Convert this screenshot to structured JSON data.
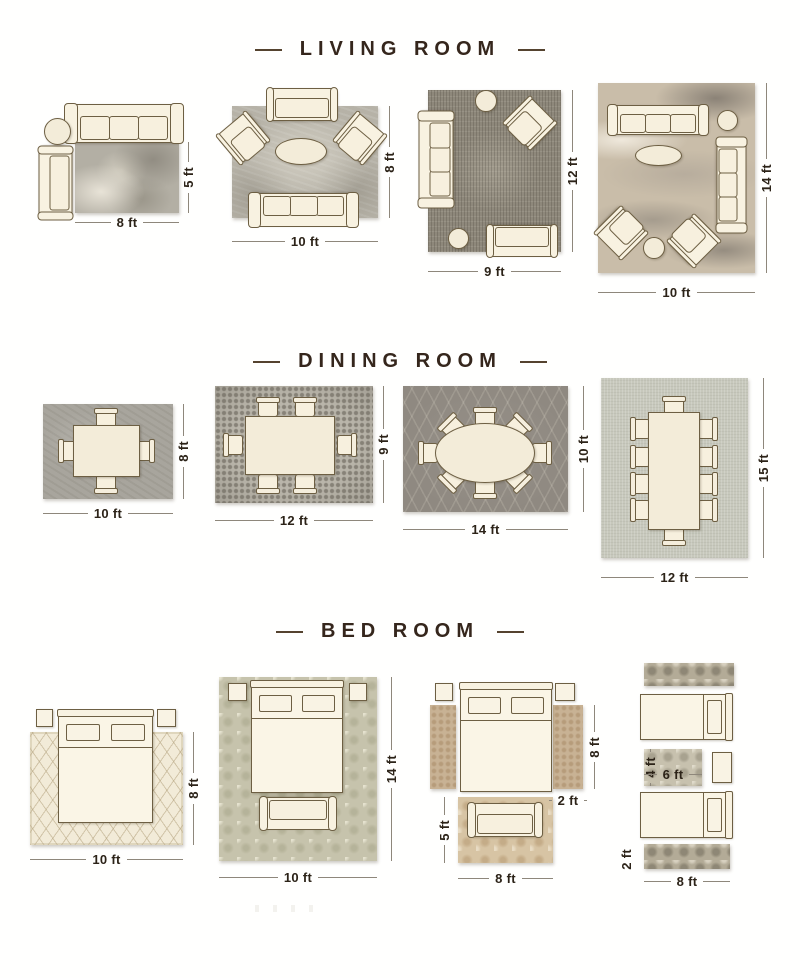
{
  "colors": {
    "background": "#ffffff",
    "title_text": "#35261c",
    "dimension_text": "#2c2318",
    "dimension_line": "#8e877b",
    "furniture_fill": "#f8f2e1",
    "furniture_outline": "#6d5f43"
  },
  "sections": {
    "living": {
      "title": "LIVING ROOM",
      "layouts": [
        {
          "width": "8 ft",
          "height": "5 ft"
        },
        {
          "width": "10 ft",
          "height": "8 ft"
        },
        {
          "width": "9 ft",
          "height": "12 ft"
        },
        {
          "width": "10 ft",
          "height": "14 ft"
        }
      ]
    },
    "dining": {
      "title": "DINING ROOM",
      "layouts": [
        {
          "width": "10 ft",
          "height": "8 ft"
        },
        {
          "width": "12 ft",
          "height": "9 ft"
        },
        {
          "width": "14 ft",
          "height": "10 ft"
        },
        {
          "width": "12 ft",
          "height": "15 ft"
        }
      ]
    },
    "bedroom": {
      "title": "BED ROOM",
      "layouts": [
        {
          "width": "10 ft",
          "height": "8 ft"
        },
        {
          "width": "10 ft",
          "height": "14 ft"
        },
        {
          "side_rug_height": "8 ft",
          "side_rug_width": "2 ft",
          "front_rug_height": "5 ft",
          "front_rug_width": "8 ft"
        },
        {
          "accent_rug_height": "4 ft",
          "accent_rug_width": "6 ft",
          "runner_height": "2 ft",
          "runner_width": "8 ft"
        }
      ]
    }
  }
}
